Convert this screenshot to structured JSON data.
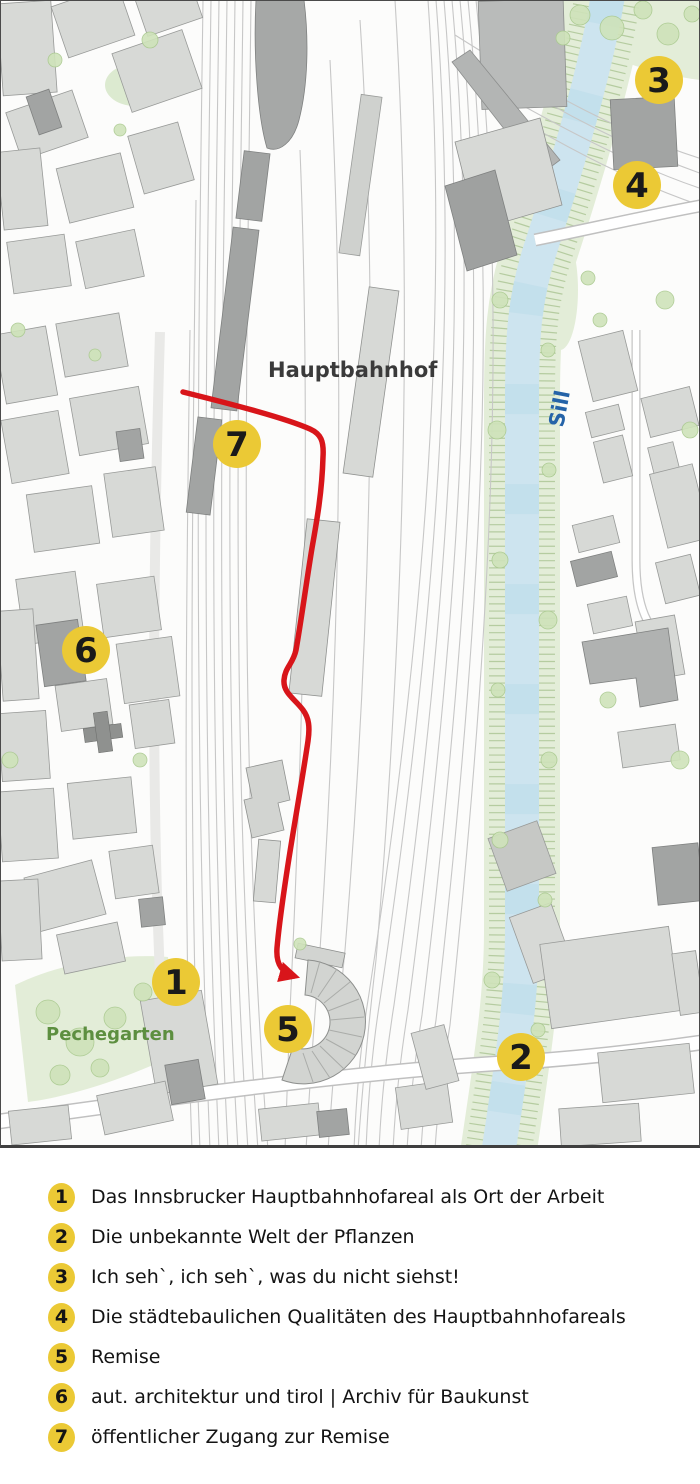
{
  "map": {
    "labels": {
      "station": "Hauptbahnhof",
      "river": "Sill",
      "park": "Pechegarten"
    },
    "markers": [
      {
        "number": "1"
      },
      {
        "number": "2"
      },
      {
        "number": "3"
      },
      {
        "number": "4"
      },
      {
        "number": "5"
      },
      {
        "number": "6"
      },
      {
        "number": "7"
      }
    ],
    "colors": {
      "marker_fill": "#ebc935",
      "route_red": "#d8151a",
      "river_blue": "#cde4ef",
      "bank_green": "#e3edd8",
      "vegetation": "#cfe3ba",
      "building_light": "#d7d9d6",
      "building_dark": "#a2a4a3",
      "station_label": "#3a3a3a",
      "river_label": "#2563a8",
      "park_label": "#5d8f40"
    }
  },
  "legend": {
    "items": [
      {
        "number": "1",
        "label": "Das Innsbrucker Hauptbahnhofareal als Ort der Arbeit"
      },
      {
        "number": "2",
        "label": "Die unbekannte Welt der Pflanzen"
      },
      {
        "number": "3",
        "label": "Ich seh`, ich seh`, was du nicht siehst!"
      },
      {
        "number": "4",
        "label": "Die städtebaulichen Qualitäten des Hauptbahnhofareals"
      },
      {
        "number": "5",
        "label": "Remise"
      },
      {
        "number": "6",
        "label": "aut. architektur und tirol | Archiv für Baukunst"
      },
      {
        "number": "7",
        "label": "öffentlicher Zugang zur Remise"
      }
    ]
  }
}
